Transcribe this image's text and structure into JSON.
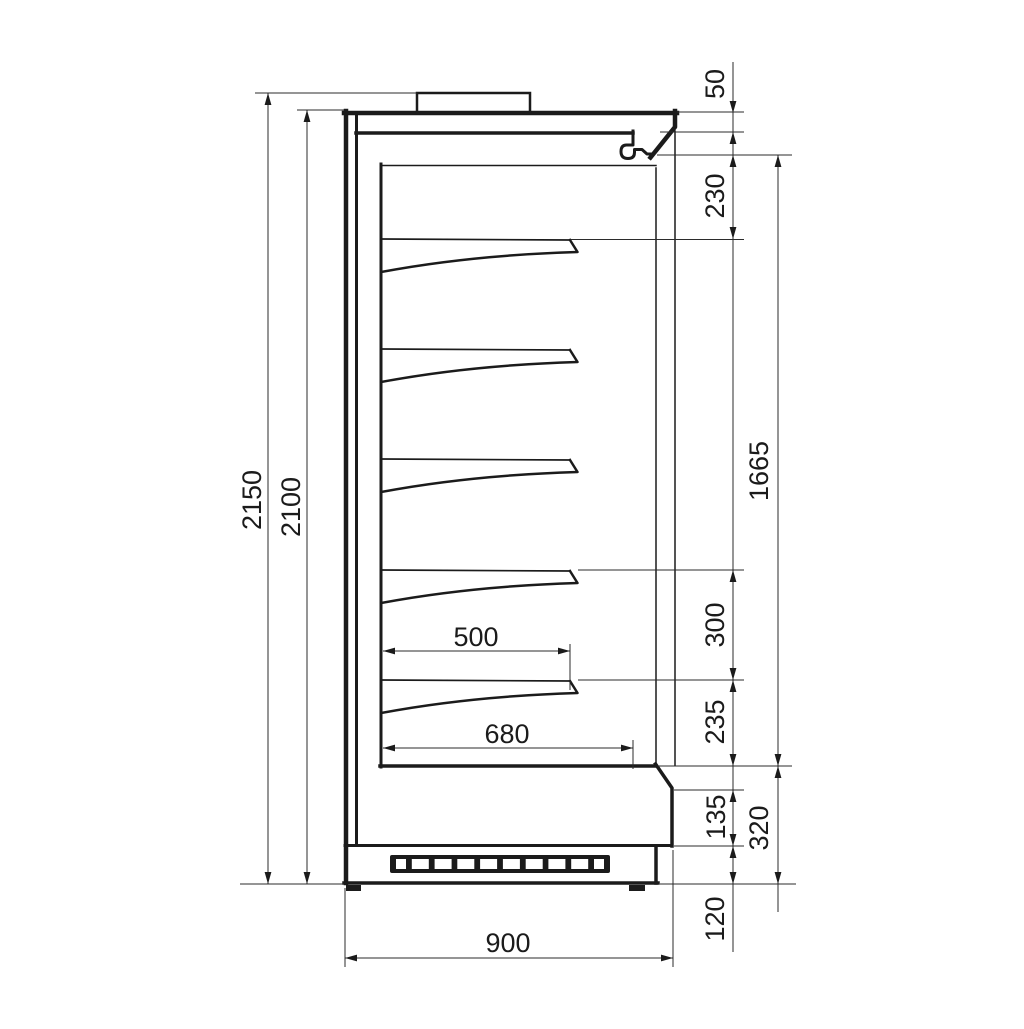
{
  "figure": {
    "shelf_count": 5,
    "vent_slot_count": 10,
    "line_color": "#1b1b1b",
    "background_color": "#ffffff"
  },
  "labels": {
    "overall_height": "2150",
    "body_height": "2100",
    "canopy_height": "50",
    "top_clearance": "230",
    "display_opening_height": "1665",
    "shelf_spacing": "300",
    "bottom_clearance": "235",
    "bumper_height": "135",
    "base_section_height": "320",
    "plinth_height": "120",
    "shelf_depth": "500",
    "well_depth": "680",
    "overall_depth": "900"
  }
}
